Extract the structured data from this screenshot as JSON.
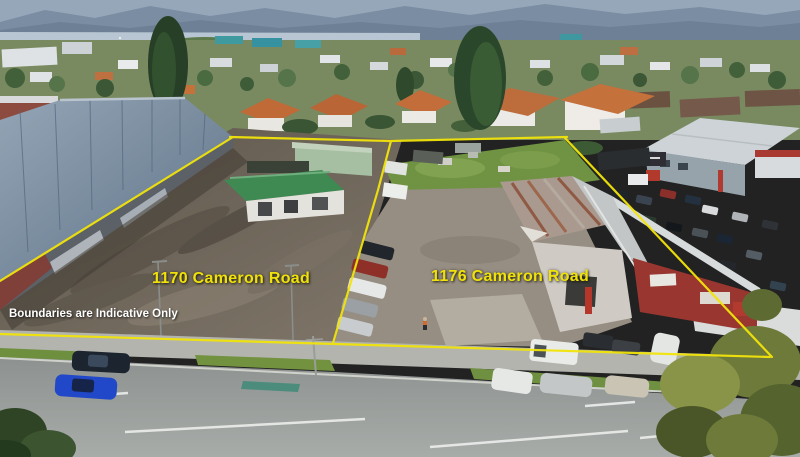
{
  "image": {
    "description": "Aerial drone photograph of two adjoining commercial properties outlined with yellow boundary lines, suburban houses and harbour in the background",
    "labels": {
      "property_left": "1170 Cameron Road",
      "property_right": "1176 Cameron Road",
      "disclaimer": "Boundaries are Indicative Only"
    },
    "colors": {
      "boundary": "#f2e40a",
      "property_label": "#f0e10a",
      "disclaimer": "#ffffff"
    }
  }
}
